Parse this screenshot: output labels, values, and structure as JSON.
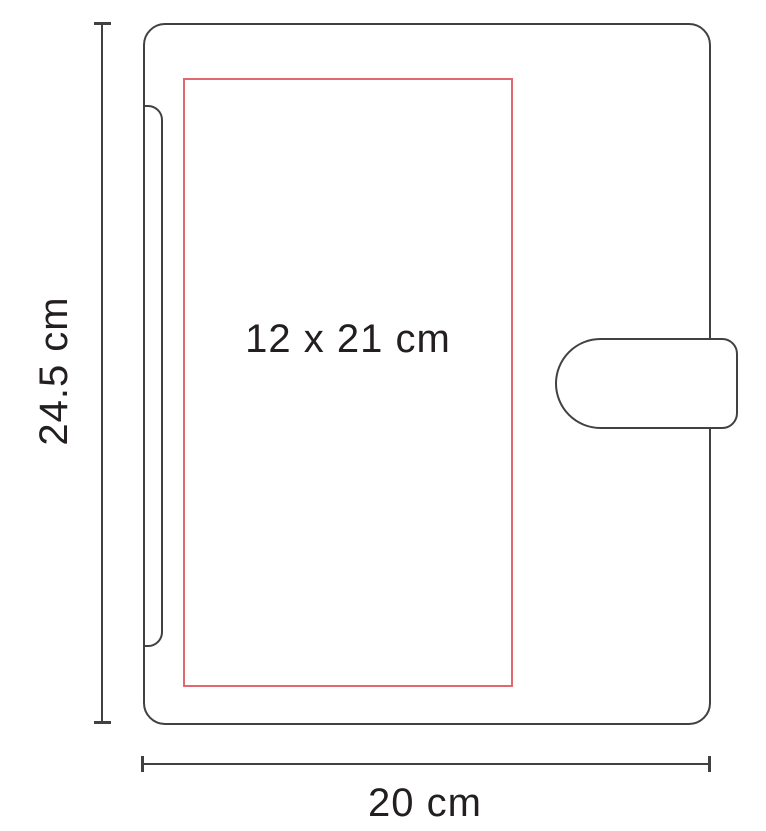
{
  "diagram": {
    "title": "notebook-dimension-diagram",
    "print_area": {
      "label": "12 x 21 cm"
    },
    "dimensions": {
      "height_label": "24.5 cm",
      "width_label": "20 cm"
    },
    "colors": {
      "outline": "#414042",
      "print_area": "#e0696f",
      "text": "#231f20",
      "background": "#ffffff"
    }
  }
}
